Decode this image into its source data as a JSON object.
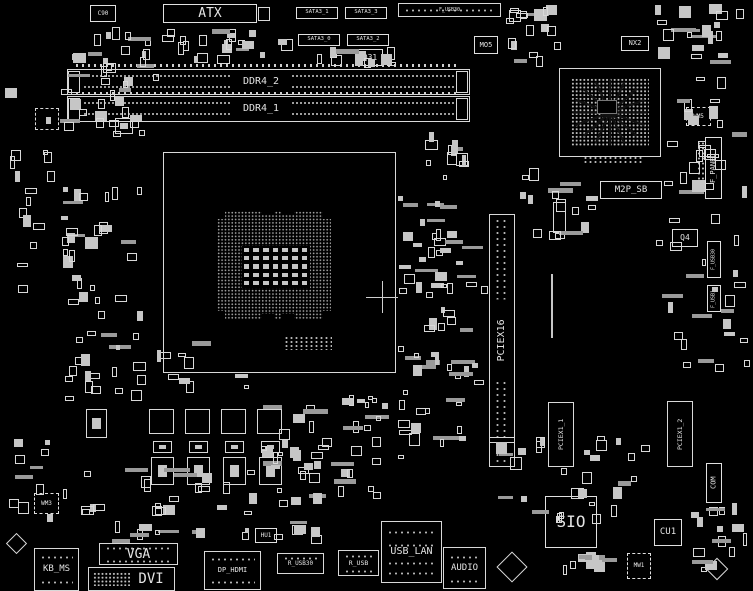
{
  "meta": {
    "type": "motherboard-boardview-diagram",
    "width": 753,
    "height": 591
  },
  "colors": {
    "bg": "#000000",
    "line": "#d8d8d8",
    "dim": "#9a9a9a",
    "text": "#e3e3e3"
  },
  "labeled_components": [
    {
      "id": "atx-connector",
      "label": "ATX",
      "x": 163,
      "y": 4,
      "w": 94,
      "h": 19,
      "fs": 13
    },
    {
      "id": "c90",
      "label": "C90",
      "x": 90,
      "y": 5,
      "w": 26,
      "h": 17,
      "fs": 6
    },
    {
      "id": "sata3-1",
      "label": "SATA3_1",
      "x": 296,
      "y": 7,
      "w": 42,
      "h": 12,
      "fs": 5.5
    },
    {
      "id": "sata3-3",
      "label": "SATA3_3",
      "x": 345,
      "y": 7,
      "w": 42,
      "h": 12,
      "fs": 5.5
    },
    {
      "id": "sata3-0",
      "label": "SATA3_0",
      "x": 298,
      "y": 34,
      "w": 42,
      "h": 12,
      "fs": 5.5
    },
    {
      "id": "sata3-2",
      "label": "SATA3_2",
      "x": 347,
      "y": 34,
      "w": 42,
      "h": 12,
      "fs": 5.5
    },
    {
      "id": "q31",
      "label": "Q31",
      "x": 357,
      "y": 49,
      "w": 26,
      "h": 17,
      "fs": 8
    },
    {
      "id": "mo5",
      "label": "MO5",
      "x": 474,
      "y": 36,
      "w": 24,
      "h": 18,
      "fs": 7
    },
    {
      "id": "nx2",
      "label": "NX2",
      "x": 621,
      "y": 36,
      "w": 28,
      "h": 15,
      "fs": 7
    },
    {
      "id": "wm5",
      "label": "WM5",
      "x": 686,
      "y": 107,
      "w": 25,
      "h": 19,
      "fs": 6,
      "dashed": 1
    },
    {
      "id": "m2p-sb",
      "label": "M2P_SB",
      "x": 600,
      "y": 181,
      "w": 62,
      "h": 18,
      "fs": 9
    },
    {
      "id": "q4",
      "label": "Q4",
      "x": 672,
      "y": 229,
      "w": 26,
      "h": 18,
      "fs": 8
    },
    {
      "id": "sio",
      "label": "SIO",
      "x": 545,
      "y": 496,
      "w": 52,
      "h": 52,
      "fs": 16
    },
    {
      "id": "cu1",
      "label": "CU1",
      "x": 654,
      "y": 519,
      "w": 28,
      "h": 27,
      "fs": 9
    },
    {
      "id": "mw1",
      "label": "MW1",
      "x": 627,
      "y": 553,
      "w": 24,
      "h": 26,
      "fs": 6,
      "dashed": 1
    },
    {
      "id": "wm3",
      "label": "WM3",
      "x": 34,
      "y": 493,
      "w": 25,
      "h": 21,
      "fs": 6,
      "dashed": 1
    },
    {
      "id": "hu1",
      "label": "HU1",
      "x": 255,
      "y": 528,
      "w": 22,
      "h": 15,
      "fs": 6
    },
    {
      "id": "f-panel-header",
      "label": "F_PANEL",
      "x": 705,
      "y": 137,
      "w": 17,
      "h": 62,
      "fs": 7,
      "v": 1
    },
    {
      "id": "f-usb30-header",
      "label": "F_USB30",
      "x": 707,
      "y": 241,
      "w": 14,
      "h": 37,
      "fs": 5,
      "v": 1
    },
    {
      "id": "f-usb1-header",
      "label": "F_USB1",
      "x": 707,
      "y": 285,
      "w": 14,
      "h": 27,
      "fs": 5,
      "v": 1
    },
    {
      "id": "com-header",
      "label": "COM",
      "x": 706,
      "y": 463,
      "w": 16,
      "h": 40,
      "fs": 7,
      "v": 1
    }
  ],
  "memory_slots": [
    {
      "id": "ddr4-2-slot",
      "label": "DDR4_2",
      "x": 67,
      "y": 69,
      "w": 403,
      "h": 26,
      "labelX": 232,
      "fs": 10
    },
    {
      "id": "ddr4-1-slot",
      "label": "DDR4_1",
      "x": 67,
      "y": 96,
      "w": 403,
      "h": 26,
      "labelX": 232,
      "fs": 10
    }
  ],
  "pcie_slots": [
    {
      "id": "pciex16-slot",
      "label": "PCIEX16",
      "x": 489,
      "y": 214,
      "w": 26,
      "h": 253,
      "fs": 10,
      "keyAt": 223
    },
    {
      "id": "pciex1-1-slot",
      "label": "PCIEX1_1",
      "x": 548,
      "y": 402,
      "w": 26,
      "h": 65,
      "fs": 6.5
    },
    {
      "id": "pciex1-2-slot",
      "label": "PCIEX1_2",
      "x": 667,
      "y": 401,
      "w": 26,
      "h": 66,
      "fs": 6.5
    }
  ],
  "io_connectors": [
    {
      "id": "kb-ms-port",
      "label": "KB_MS",
      "x": 34,
      "y": 548,
      "w": 45,
      "h": 43,
      "fs": 9,
      "dotRows": [
        7,
        32
      ]
    },
    {
      "id": "vga-port",
      "label": "VGA",
      "x": 99,
      "y": 543,
      "w": 79,
      "h": 22,
      "fs": 13,
      "dotRows": [
        3,
        16
      ]
    },
    {
      "id": "dvi-port",
      "label": "DVI",
      "x": 88,
      "y": 567,
      "w": 87,
      "h": 24,
      "fs": 14,
      "dotsLeft": 1
    },
    {
      "id": "dp-hdmi-port",
      "label": "DP_HDMI",
      "x": 204,
      "y": 551,
      "w": 57,
      "h": 39,
      "fs": 7,
      "dotRows": [
        6,
        29
      ]
    },
    {
      "id": "r-usb30-port",
      "label": "R_USB30",
      "x": 277,
      "y": 553,
      "w": 47,
      "h": 21,
      "fs": 6,
      "dotRows": [
        3
      ]
    },
    {
      "id": "r-usb-port",
      "label": "R_USB",
      "x": 338,
      "y": 550,
      "w": 41,
      "h": 26,
      "fs": 6.5,
      "dotRows": [
        4,
        19
      ]
    },
    {
      "id": "usb-lan-port",
      "label": "USB_LAN",
      "x": 381,
      "y": 521,
      "w": 61,
      "h": 62,
      "fs": 10,
      "dotRows": [
        9,
        22,
        40,
        50
      ]
    },
    {
      "id": "audio-port",
      "label": "AUDIO",
      "x": 443,
      "y": 547,
      "w": 43,
      "h": 42,
      "fs": 9,
      "dotRows": [
        8,
        32
      ]
    },
    {
      "id": "f-usb30-top",
      "label": "F_USB30",
      "x": 398,
      "y": 3,
      "w": 103,
      "h": 14,
      "fs": 5,
      "dotRows": [
        5
      ]
    }
  ],
  "cpu_socket": {
    "id": "cpu-socket",
    "outer": {
      "x": 163,
      "y": 152,
      "w": 233,
      "h": 221
    },
    "pins": {
      "x": 217,
      "y": 211,
      "w": 114,
      "h": 108
    },
    "notches": [
      {
        "x": 262,
        "y": 209,
        "w": 12,
        "h": 6
      },
      {
        "x": 282,
        "y": 209,
        "w": 12,
        "h": 6
      },
      {
        "x": 262,
        "y": 314,
        "w": 12,
        "h": 6
      },
      {
        "x": 282,
        "y": 314,
        "w": 12,
        "h": 6
      },
      {
        "x": 217,
        "y": 211,
        "w": 8,
        "h": 8
      },
      {
        "x": 323,
        "y": 211,
        "w": 8,
        "h": 8
      },
      {
        "x": 217,
        "y": 311,
        "w": 8,
        "h": 8
      },
      {
        "x": 323,
        "y": 311,
        "w": 8,
        "h": 8
      }
    ],
    "caps": {
      "x": 242,
      "y": 246,
      "w": 68,
      "h": 42,
      "rows": 5,
      "cols": 7
    },
    "cross": {
      "x": 382,
      "y": 297,
      "arm": 16
    }
  },
  "chipset_bga": {
    "id": "chipset-bga",
    "outer": {
      "x": 559,
      "y": 68,
      "w": 102,
      "h": 89
    },
    "pads": {
      "x": 571,
      "y": 78,
      "w": 78,
      "h": 69
    },
    "core": {
      "x": 597,
      "y": 100,
      "w": 20,
      "h": 14
    }
  },
  "dot_strips": [
    {
      "id": "m2-connector-pads",
      "x": 583,
      "y": 156,
      "w": 60,
      "h": 9
    },
    {
      "id": "socket-bottom-pads",
      "x": 284,
      "y": 336,
      "w": 48,
      "h": 14
    },
    {
      "id": "f-panel-pin-column",
      "x": 697,
      "y": 141,
      "w": 8,
      "h": 52,
      "v": 1
    }
  ],
  "tick_rows": [
    {
      "x": 76,
      "y": 64,
      "w": 384,
      "h": 3
    },
    {
      "x": 76,
      "y": 92,
      "w": 384,
      "h": 3
    }
  ],
  "extra_rects": [
    {
      "x": 68,
      "y": 71,
      "w": 12,
      "h": 22
    },
    {
      "x": 456,
      "y": 71,
      "w": 12,
      "h": 22
    },
    {
      "x": 68,
      "y": 98,
      "w": 12,
      "h": 22
    },
    {
      "x": 456,
      "y": 98,
      "w": 12,
      "h": 22
    },
    {
      "x": 258,
      "y": 7,
      "w": 12,
      "h": 14
    },
    {
      "x": 551,
      "y": 274,
      "w": 2,
      "h": 64,
      "fill": 1
    },
    {
      "x": 553,
      "y": 202,
      "w": 13,
      "h": 31
    },
    {
      "x": 149,
      "y": 409,
      "w": 25,
      "h": 25
    },
    {
      "x": 185,
      "y": 409,
      "w": 25,
      "h": 25
    },
    {
      "x": 221,
      "y": 409,
      "w": 25,
      "h": 25
    },
    {
      "x": 257,
      "y": 409,
      "w": 25,
      "h": 25
    },
    {
      "x": 153,
      "y": 441,
      "w": 19,
      "h": 12,
      "inner": 1
    },
    {
      "x": 189,
      "y": 441,
      "w": 19,
      "h": 12,
      "inner": 1
    },
    {
      "x": 225,
      "y": 441,
      "w": 19,
      "h": 12,
      "inner": 1
    },
    {
      "x": 261,
      "y": 441,
      "w": 19,
      "h": 12,
      "inner": 1
    },
    {
      "x": 151,
      "y": 457,
      "w": 23,
      "h": 28,
      "inner": 1
    },
    {
      "x": 187,
      "y": 457,
      "w": 23,
      "h": 28,
      "inner": 1
    },
    {
      "x": 223,
      "y": 457,
      "w": 23,
      "h": 28,
      "inner": 1
    },
    {
      "x": 259,
      "y": 457,
      "w": 23,
      "h": 28,
      "inner": 1
    },
    {
      "x": 86,
      "y": 409,
      "w": 21,
      "h": 29,
      "inner": 1
    },
    {
      "x": 35,
      "y": 108,
      "w": 24,
      "h": 22,
      "dashed": 1
    },
    {
      "x": 115,
      "y": 118,
      "w": 18,
      "h": 16,
      "inner": 1
    }
  ],
  "diamonds": [
    {
      "cx": 512,
      "cy": 567,
      "s": 22
    },
    {
      "cx": 16,
      "cy": 543,
      "s": 15
    },
    {
      "cx": 717,
      "cy": 569,
      "s": 16
    }
  ],
  "noise_clusters": [
    {
      "x": 58,
      "y": 25,
      "w": 105,
      "h": 120,
      "n": 40,
      "fp": 0.35
    },
    {
      "x": 160,
      "y": 25,
      "w": 150,
      "h": 40,
      "n": 22,
      "fp": 0.3
    },
    {
      "x": 310,
      "y": 47,
      "w": 90,
      "h": 22,
      "n": 12,
      "fp": 0.3
    },
    {
      "x": 505,
      "y": 2,
      "w": 60,
      "h": 66,
      "n": 18,
      "fp": 0.3
    },
    {
      "x": 655,
      "y": 2,
      "w": 95,
      "h": 66,
      "n": 20,
      "fp": 0.3
    },
    {
      "x": 662,
      "y": 75,
      "w": 88,
      "h": 150,
      "n": 26,
      "fp": 0.3
    },
    {
      "x": 2,
      "y": 85,
      "w": 55,
      "h": 220,
      "n": 16,
      "fp": 0.3
    },
    {
      "x": 58,
      "y": 185,
      "w": 85,
      "h": 145,
      "n": 30,
      "fp": 0.35
    },
    {
      "x": 58,
      "y": 330,
      "w": 90,
      "h": 75,
      "n": 20,
      "fp": 0.3
    },
    {
      "x": 398,
      "y": 185,
      "w": 90,
      "h": 150,
      "n": 40,
      "fp": 0.35
    },
    {
      "x": 398,
      "y": 340,
      "w": 88,
      "h": 130,
      "n": 30,
      "fp": 0.3
    },
    {
      "x": 408,
      "y": 125,
      "w": 65,
      "h": 55,
      "n": 12,
      "fp": 0.3
    },
    {
      "x": 520,
      "y": 160,
      "w": 78,
      "h": 95,
      "n": 16,
      "fp": 0.3
    },
    {
      "x": 655,
      "y": 235,
      "w": 95,
      "h": 160,
      "n": 22,
      "fp": 0.3
    },
    {
      "x": 330,
      "y": 390,
      "w": 60,
      "h": 125,
      "n": 22,
      "fp": 0.3
    },
    {
      "x": 60,
      "y": 460,
      "w": 268,
      "h": 62,
      "n": 36,
      "fp": 0.3
    },
    {
      "x": 495,
      "y": 432,
      "w": 158,
      "h": 92,
      "n": 30,
      "fp": 0.35
    },
    {
      "x": 560,
      "y": 552,
      "w": 62,
      "h": 36,
      "n": 10,
      "fp": 0.3
    },
    {
      "x": 685,
      "y": 500,
      "w": 66,
      "h": 88,
      "n": 16,
      "fp": 0.3
    },
    {
      "x": 2,
      "y": 430,
      "w": 52,
      "h": 95,
      "n": 10,
      "fp": 0.3
    },
    {
      "x": 150,
      "y": 340,
      "w": 100,
      "h": 55,
      "n": 10,
      "fp": 0.25
    },
    {
      "x": 255,
      "y": 392,
      "w": 80,
      "h": 88,
      "n": 18,
      "fp": 0.3
    },
    {
      "x": 85,
      "y": 520,
      "w": 240,
      "h": 24,
      "n": 18,
      "fp": 0.4
    }
  ]
}
